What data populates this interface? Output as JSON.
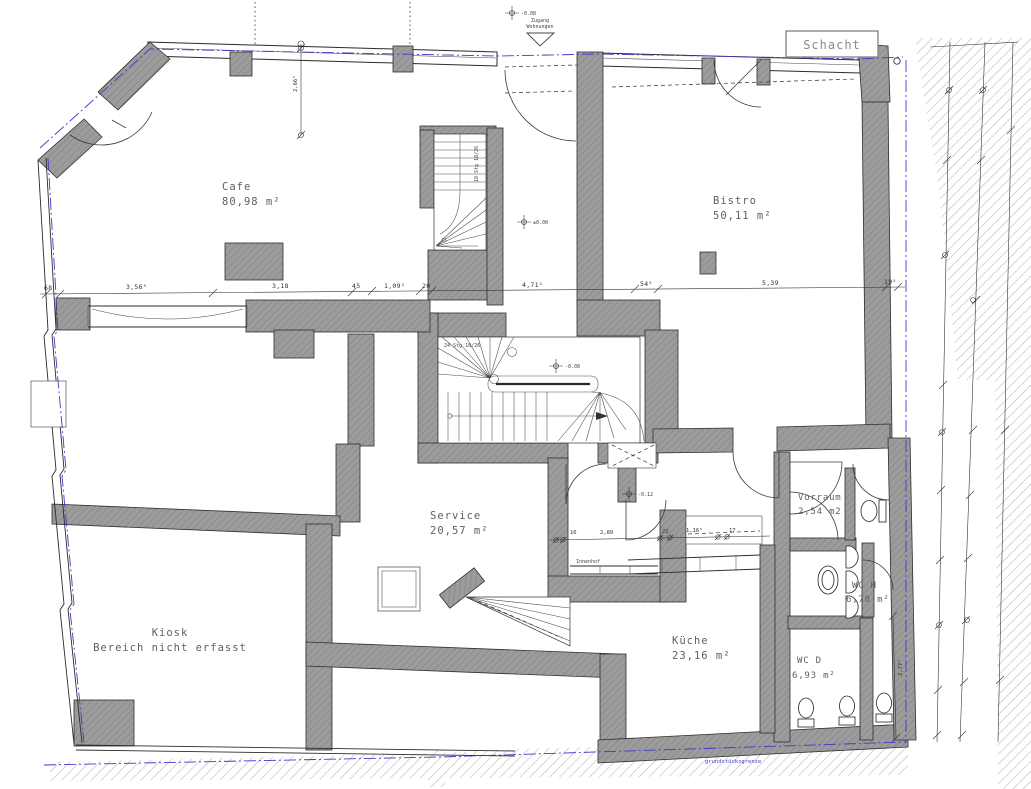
{
  "drawing": {
    "rooms": [
      {
        "id": "cafe",
        "name": "Cafe",
        "area": "80,98 m²"
      },
      {
        "id": "bistro",
        "name": "Bistro",
        "area": "50,11 m²"
      },
      {
        "id": "service",
        "name": "Service",
        "area": "20,57 m²"
      },
      {
        "id": "kueche",
        "name": "Küche",
        "area": "23,16 m²"
      },
      {
        "id": "kiosk",
        "name": "Kiosk",
        "area": "Bereich nicht erfasst"
      },
      {
        "id": "vorraum",
        "name": "Vorraum",
        "area": "2,54 m2"
      },
      {
        "id": "wc_h",
        "name": "WC H",
        "area": "6,78 m²"
      },
      {
        "id": "wc_d",
        "name": "WC D",
        "area": "6,93 m²"
      }
    ],
    "annotations": {
      "schacht": "Schacht",
      "zugang_line1": "Zugang",
      "zugang_line2": "Wohnungen",
      "innenhof": "Innenhof",
      "property_line": "grundstücksgrenze",
      "stair_main_note": "24 Stg 18/26",
      "stair_small_note": "18 Stg 18/26"
    },
    "elevations": {
      "top_entry": "-0.08",
      "corridor": "±0.00",
      "stair_hall": "-0.08",
      "hall": "-0.12"
    },
    "dimensions": {
      "main_chain": [
        "68",
        "3,56⁵",
        "3,18",
        "45",
        "1,09⁵",
        "20",
        "4,71⁵",
        "54⁵",
        "5,39",
        "19⁵"
      ],
      "mid_chain": [
        "16",
        "2,89",
        "22",
        "1,16⁵",
        "17"
      ],
      "cafe_height": "2,66⁵",
      "right_height": "2,77⁵"
    },
    "colors": {
      "wall_gray": "#9c9c9c",
      "hatch_line": "#8a8a8a",
      "property_blue": "#3c3ccc",
      "label_gray": "#5f5f5f"
    }
  }
}
